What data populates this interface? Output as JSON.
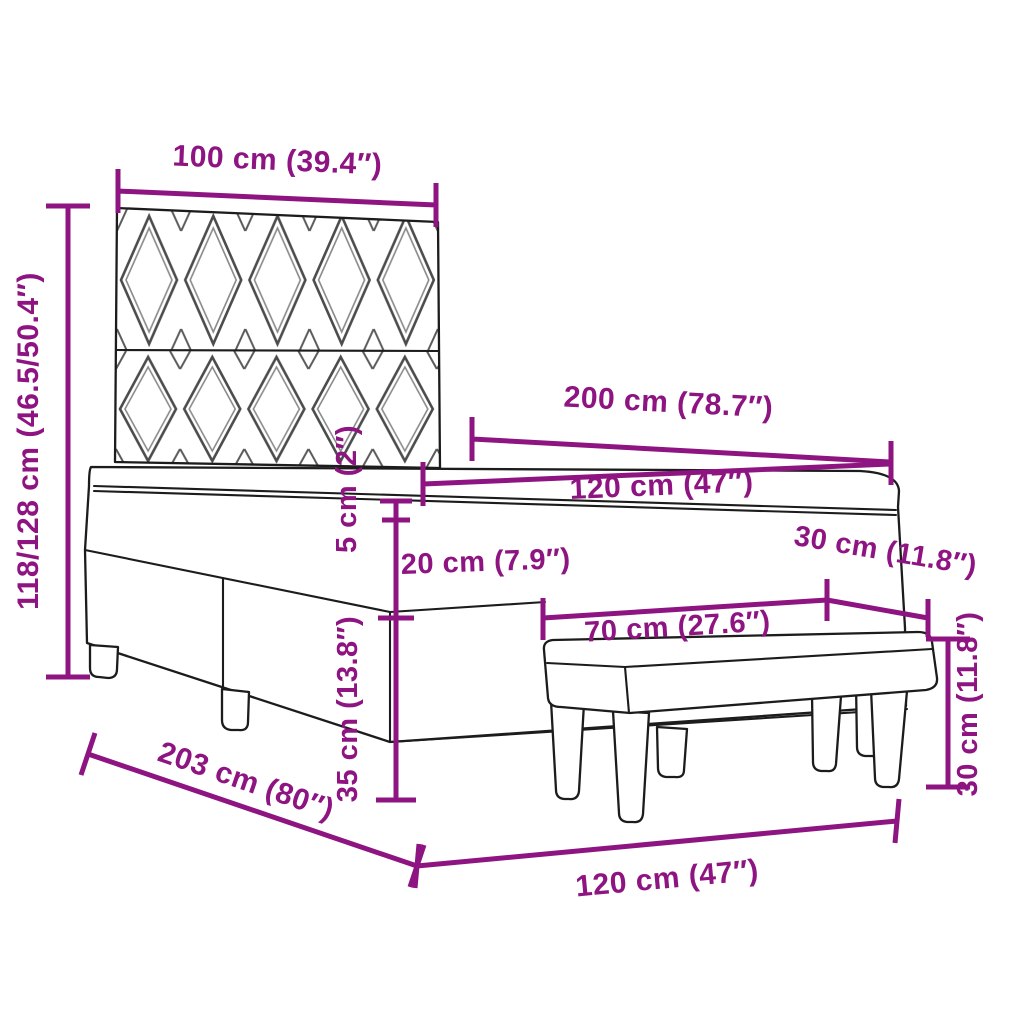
{
  "diagram": {
    "accent_color": "#8e1482",
    "outline_color": "#1c1c1c",
    "labels": {
      "headboard_width": "100 cm (39.4″)",
      "total_height": "118/128 cm (46.5/50.4″)",
      "bed_length": "200 cm (78.7″)",
      "mattress_width": "120 cm (47″)",
      "topper_height": "5 cm (2″)",
      "mattress_height": "20 cm (7.9″)",
      "bench_depth": "30 cm (11.8″)",
      "bench_length": "70 cm (27.6″)",
      "bench_height": "30 cm (11.8″)",
      "base_height": "35 cm (13.8″)",
      "frame_length": "203 cm (80″)",
      "frame_width": "120 cm (47″)"
    }
  }
}
